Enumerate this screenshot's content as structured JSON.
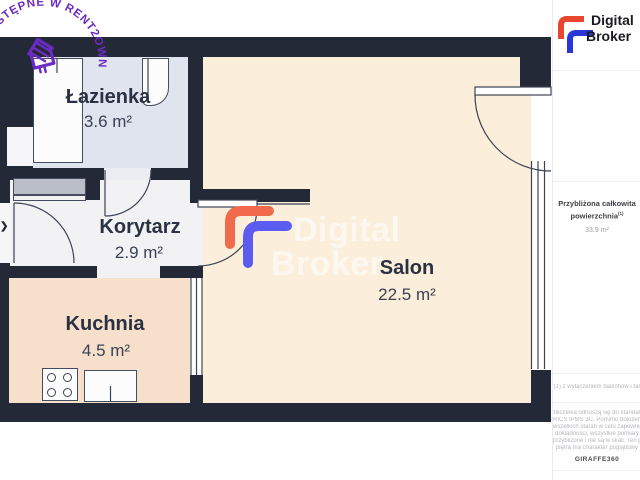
{
  "stamp": {
    "text": "DOSTĘPNE W RENT2OWN",
    "color": "#6c2bc2",
    "icon": "house-icon"
  },
  "rooms": [
    {
      "id": "lazienka",
      "name": "Łazienka",
      "area": "3.6 m²"
    },
    {
      "id": "korytarz",
      "name": "Korytarz",
      "area": "2.9 m²"
    },
    {
      "id": "kuchnia",
      "name": "Kuchnia",
      "area": "4.5 m²"
    },
    {
      "id": "salon",
      "name": "Salon",
      "area": "22.5 m²"
    }
  ],
  "entrance": {
    "arrow": "❯"
  },
  "watermark": {
    "line1": "Digital",
    "line2": "Broker"
  },
  "fixtures": [
    "bathtub",
    "washbasin",
    "wardrobe",
    "stove",
    "kitchen-counter"
  ],
  "sidebar": {
    "logo": {
      "line1": "Digital",
      "line2": "Broker"
    },
    "summary": {
      "title_line1": "Przybliżona całkowita",
      "title_line2": "powierzchnia",
      "footnote_marker": "(1)",
      "value": "33.9 m²"
    },
    "footnote": "(1) z wyłączeniem balkonów i tar",
    "disclaimer_lines": [
      "bliczenia odnoszą się do standar",
      "RICS IPMS 3C. Pomimo dołożeni",
      "wszelkich starań w celu zapewnie",
      "dokładności, wszystkie pomiary",
      "przybliżone i nie są w skali. Ten p",
      "piętra ma charakter poglądowy"
    ],
    "brand": "GIRAFFE360"
  },
  "colors": {
    "wall": "#232937",
    "bathroom_floor": "#e0e4ef",
    "corridor_floor": "#f2f2f5",
    "kitchen_floor": "#f6e0cc",
    "salon_floor": "#fbeeda",
    "stamp_purple": "#6c2bc2",
    "logo_orange": "#e8462e",
    "logo_blue": "#2b36d8",
    "watermark_orange": "#f26a4c",
    "watermark_blue": "#5c5cf0"
  }
}
